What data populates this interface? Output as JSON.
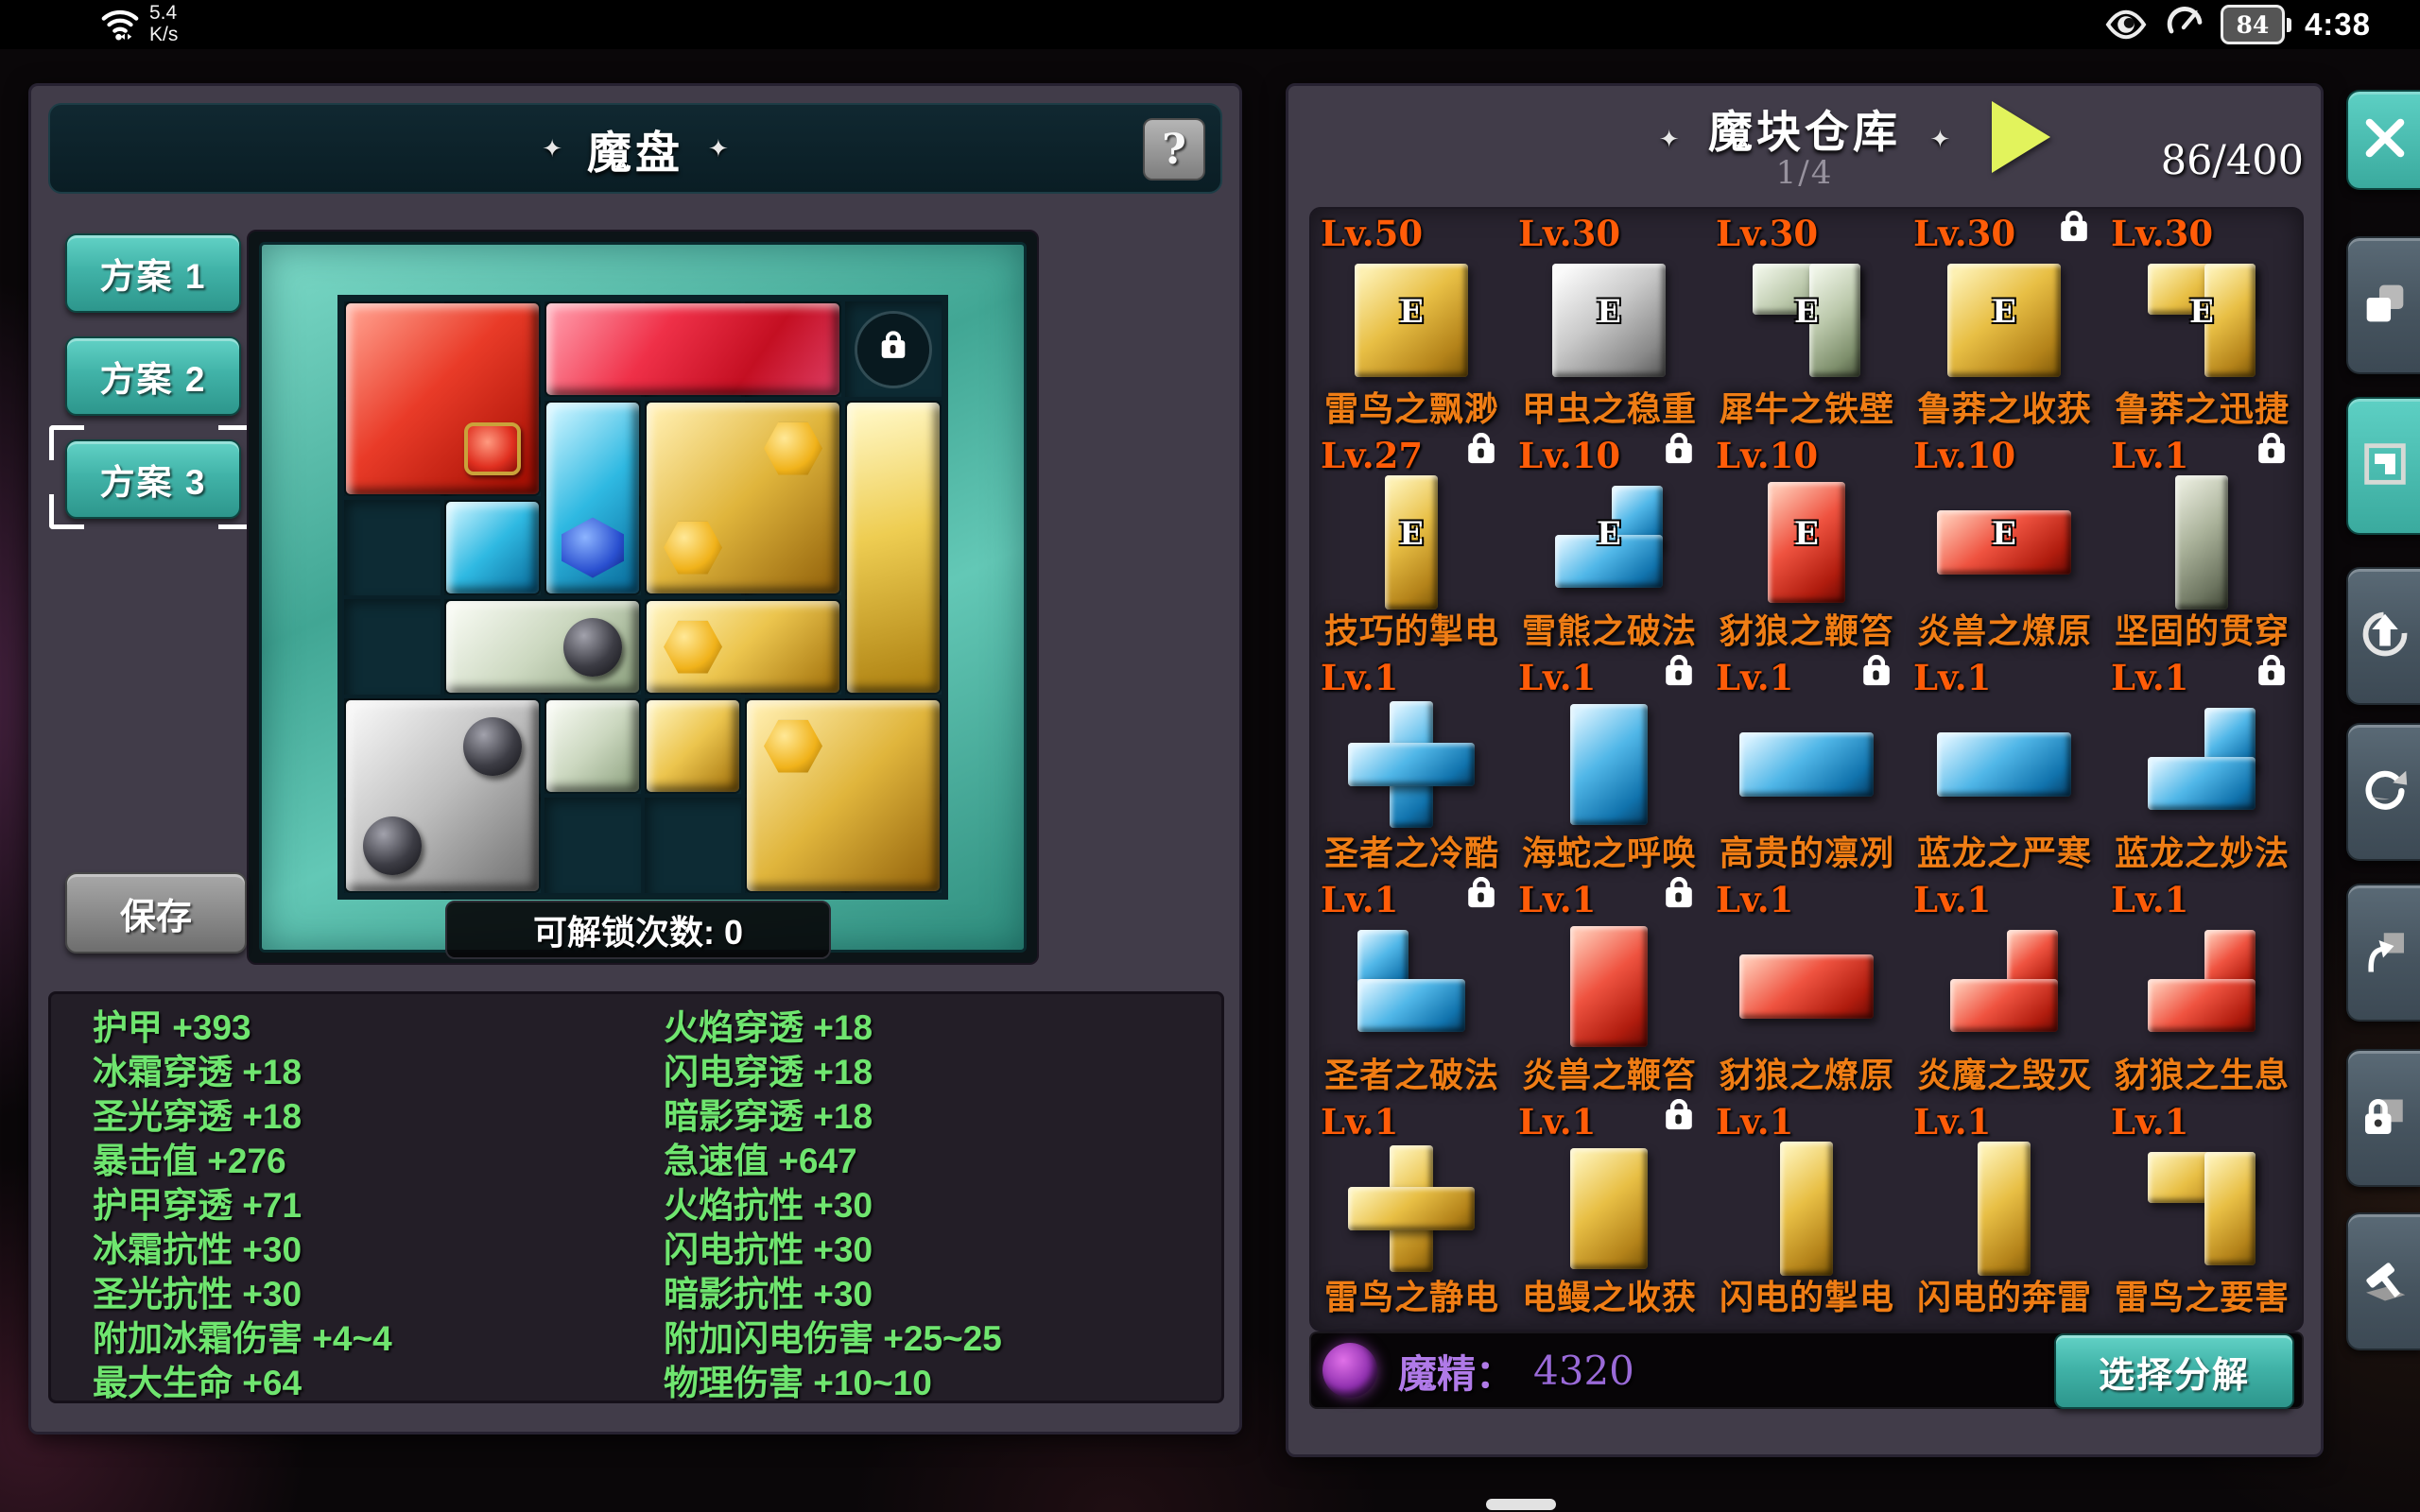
{
  "status_bar": {
    "net_speed": "5.4",
    "net_unit": "K/s",
    "battery_level": "84",
    "time": "4:38"
  },
  "left_panel": {
    "title": "魔盘",
    "title_deco": "✦",
    "help_label": "?",
    "schemes": [
      {
        "label": "方案 1",
        "selected": false
      },
      {
        "label": "方案 2",
        "selected": false
      },
      {
        "label": "方案 3",
        "selected": true
      }
    ],
    "save_label": "保存",
    "unlock_text": "可解锁次数: 0",
    "board": {
      "rows": 6,
      "cols": 6,
      "locked_cells": [
        [
          1,
          6
        ]
      ],
      "pieces": [
        {
          "id": "red-square",
          "color": "red",
          "rects": [
            [
              1,
              1,
              2,
              2
            ]
          ],
          "gems": [
            {
              "type": "red",
              "r": 2,
              "c": 2
            }
          ]
        },
        {
          "id": "red-bar",
          "color": "red2",
          "rects": [
            [
              1,
              3,
              1,
              3
            ]
          ],
          "gems": []
        },
        {
          "id": "cyan-elbow",
          "color": "cyan",
          "rects": [
            [
              2,
              3,
              2,
              1
            ],
            [
              3,
              2,
              1,
              1
            ]
          ],
          "gems": [
            {
              "type": "blue",
              "r": 3,
              "c": 3
            }
          ]
        },
        {
          "id": "gold-square",
          "color": "gold",
          "rects": [
            [
              2,
              4,
              2,
              2
            ]
          ],
          "gems": [
            {
              "type": "goldhex",
              "r": 2,
              "c": 5
            },
            {
              "type": "goldhex",
              "r": 3,
              "c": 4
            }
          ]
        },
        {
          "id": "gold-bar",
          "color": "goldlight",
          "rects": [
            [
              2,
              6,
              3,
              1
            ]
          ],
          "gems": []
        },
        {
          "id": "white-elbow",
          "color": "white",
          "rects": [
            [
              4,
              2,
              1,
              2
            ],
            [
              5,
              3,
              1,
              1
            ]
          ],
          "gems": [
            {
              "type": "black",
              "r": 4,
              "c": 3
            }
          ]
        },
        {
          "id": "gold-elbow",
          "color": "gold2",
          "rects": [
            [
              4,
              4,
              1,
              2
            ],
            [
              5,
              4,
              1,
              1
            ]
          ],
          "gems": [
            {
              "type": "goldhex",
              "r": 4,
              "c": 4
            }
          ]
        },
        {
          "id": "silver-square",
          "color": "silver",
          "rects": [
            [
              5,
              1,
              2,
              2
            ]
          ],
          "gems": [
            {
              "type": "black",
              "r": 5,
              "c": 2
            },
            {
              "type": "black",
              "r": 6,
              "c": 1
            }
          ]
        },
        {
          "id": "gold-square-2",
          "color": "gold",
          "rects": [
            [
              5,
              5,
              2,
              2
            ]
          ],
          "gems": [
            {
              "type": "goldhex",
              "r": 5,
              "c": 5
            }
          ]
        }
      ]
    },
    "stats_left": [
      "护甲 +393",
      "冰霜穿透 +18",
      "圣光穿透 +18",
      "暴击值 +276",
      "护甲穿透 +71",
      "冰霜抗性 +30",
      "圣光抗性 +30",
      "附加冰霜伤害 +4~4",
      "最大生命 +64"
    ],
    "stats_right": [
      "火焰穿透 +18",
      "闪电穿透 +18",
      "暗影穿透 +18",
      "急速值 +647",
      "火焰抗性 +30",
      "闪电抗性 +30",
      "暗影抗性 +30",
      "附加闪电伤害 +25~25",
      "物理伤害 +10~10"
    ]
  },
  "right_panel": {
    "title": "魔块仓库",
    "title_deco": "✦",
    "page_indicator": "1/4",
    "count": "86/400",
    "warehouse_items": [
      {
        "lv": "Lv.50",
        "locked": false,
        "shape": "sq",
        "color": "gold",
        "badge": "E",
        "name": "雷鸟之飘渺"
      },
      {
        "lv": "Lv.30",
        "locked": false,
        "shape": "sq",
        "color": "silver",
        "badge": "E",
        "name": "甲虫之稳重"
      },
      {
        "lv": "Lv.30",
        "locked": false,
        "shape": "g",
        "color": "sgreen",
        "badge": "E",
        "name": "犀牛之铁壁"
      },
      {
        "lv": "Lv.30",
        "locked": true,
        "shape": "sq",
        "color": "gold",
        "badge": "E",
        "name": "鲁莽之收获"
      },
      {
        "lv": "Lv.30",
        "locked": false,
        "shape": "g",
        "color": "gold",
        "badge": "E",
        "name": "鲁莽之迅捷"
      },
      {
        "lv": "Lv.27",
        "locked": true,
        "shape": "bv",
        "color": "gold",
        "badge": "E",
        "name": "技巧的掣电"
      },
      {
        "lv": "Lv.10",
        "locked": true,
        "shape": "j",
        "color": "blue",
        "badge": "E",
        "name": "雪熊之破法"
      },
      {
        "lv": "Lv.10",
        "locked": false,
        "shape": "rv",
        "color": "red",
        "badge": "E",
        "name": "豺狼之鞭笞"
      },
      {
        "lv": "Lv.10",
        "locked": false,
        "shape": "rh",
        "color": "red",
        "badge": "E",
        "name": "炎兽之燎原"
      },
      {
        "lv": "Lv.1",
        "locked": true,
        "shape": "bv",
        "color": "ggreen",
        "badge": "",
        "name": "坚固的贯穿"
      },
      {
        "lv": "Lv.1",
        "locked": false,
        "shape": "cross",
        "color": "blue",
        "badge": "",
        "name": "圣者之冷酷"
      },
      {
        "lv": "Lv.1",
        "locked": true,
        "shape": "rv",
        "color": "blue",
        "badge": "",
        "name": "海蛇之呼唤"
      },
      {
        "lv": "Lv.1",
        "locked": true,
        "shape": "rh",
        "color": "blue",
        "badge": "",
        "name": "高贵的凛冽"
      },
      {
        "lv": "Lv.1",
        "locked": false,
        "shape": "rh",
        "color": "blue",
        "badge": "",
        "name": "蓝龙之严寒"
      },
      {
        "lv": "Lv.1",
        "locked": true,
        "shape": "j",
        "color": "blue",
        "badge": "",
        "name": "蓝龙之妙法"
      },
      {
        "lv": "Lv.1",
        "locked": true,
        "shape": "l",
        "color": "blue",
        "badge": "",
        "name": "圣者之破法"
      },
      {
        "lv": "Lv.1",
        "locked": true,
        "shape": "rv",
        "color": "red",
        "badge": "",
        "name": "炎兽之鞭笞"
      },
      {
        "lv": "Lv.1",
        "locked": false,
        "shape": "rh",
        "color": "red",
        "badge": "",
        "name": "豺狼之燎原"
      },
      {
        "lv": "Lv.1",
        "locked": false,
        "shape": "j",
        "color": "red",
        "badge": "",
        "name": "炎魔之毁灭"
      },
      {
        "lv": "Lv.1",
        "locked": false,
        "shape": "j",
        "color": "red",
        "badge": "",
        "name": "豺狼之生息"
      },
      {
        "lv": "Lv.1",
        "locked": false,
        "shape": "cross",
        "color": "gold",
        "badge": "",
        "name": "雷鸟之静电"
      },
      {
        "lv": "Lv.1",
        "locked": true,
        "shape": "rv",
        "color": "gold",
        "badge": "",
        "name": "电鳗之收获"
      },
      {
        "lv": "Lv.1",
        "locked": false,
        "shape": "bv",
        "color": "gold",
        "badge": "",
        "name": "闪电的掣电"
      },
      {
        "lv": "Lv.1",
        "locked": false,
        "shape": "bv",
        "color": "gold",
        "badge": "",
        "name": "闪电的奔雷"
      },
      {
        "lv": "Lv.1",
        "locked": false,
        "shape": "g",
        "color": "gold",
        "badge": "",
        "name": "雷鸟之要害"
      }
    ],
    "bottom_bar": {
      "mana_label": "魔精：",
      "mana_value": "4320",
      "decompose_label": "选择分解"
    }
  },
  "toolbar": {
    "buttons": [
      {
        "name": "close",
        "icon": "close-icon",
        "style": "teal"
      },
      {
        "name": "copy-block",
        "icon": "copy-icon",
        "style": "slate"
      },
      {
        "name": "select-block",
        "icon": "block-select-icon",
        "style": "teal"
      },
      {
        "name": "upgrade",
        "icon": "arrow-up-circle-icon",
        "style": "slate"
      },
      {
        "name": "rotate",
        "icon": "rotate-icon",
        "style": "slate"
      },
      {
        "name": "move-out",
        "icon": "arrow-up-square-icon",
        "style": "slate"
      },
      {
        "name": "lock",
        "icon": "lock-square-icon",
        "style": "slate"
      },
      {
        "name": "decompose-hammer",
        "icon": "hammer-icon",
        "style": "slate"
      }
    ]
  },
  "colors": {
    "accent_teal": "#41b3a8",
    "level_orange": "#ff5c08",
    "name_orange": "#ef7d15",
    "stat_green": "#6fe56f",
    "mana_purple": "#9a6ad8",
    "play_arrow": "#e2f35c"
  }
}
